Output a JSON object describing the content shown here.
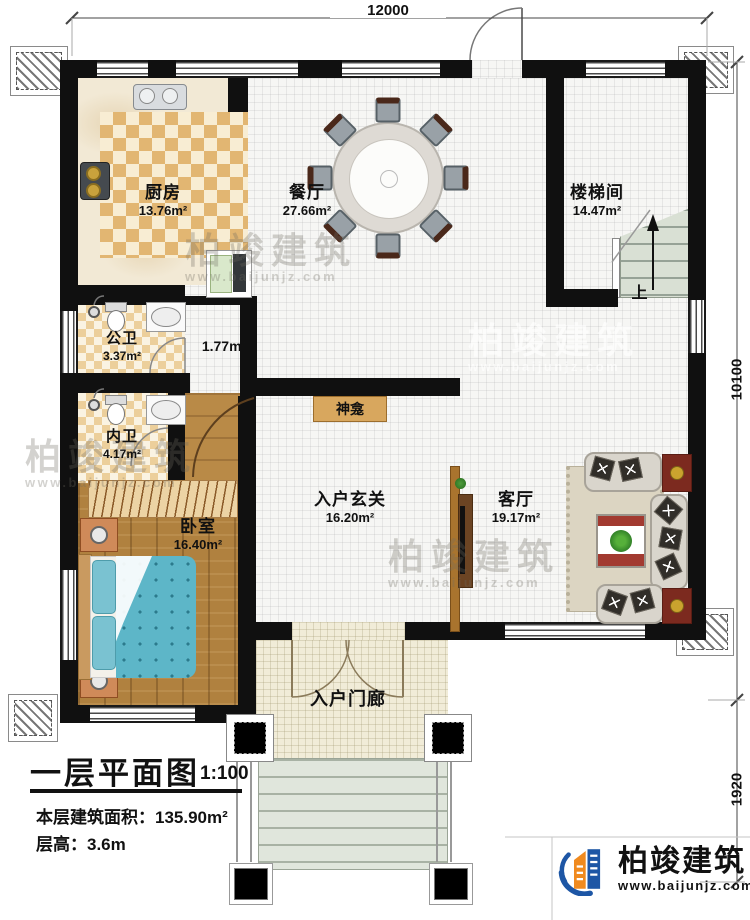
{
  "dimensions": {
    "top": "12000",
    "right_main": "10100",
    "right_porch": "1920"
  },
  "rooms": [
    {
      "name": "厨房",
      "area": "13.76m²"
    },
    {
      "name": "餐厅",
      "area": "27.66m²"
    },
    {
      "name": "楼梯间",
      "area": "14.47m²"
    },
    {
      "name": "公卫",
      "area": "3.37m²"
    },
    {
      "name": "",
      "area": "1.77m²"
    },
    {
      "name": "内卫",
      "area": "4.17m²"
    },
    {
      "name": "卧室",
      "area": "16.40m²"
    },
    {
      "name": "入户玄关",
      "area": "16.20m²"
    },
    {
      "name": "客厅",
      "area": "19.17m²"
    },
    {
      "name": "入户门廊",
      "area": ""
    }
  ],
  "labels": {
    "shrine": "神龛",
    "stairs_up": "上"
  },
  "title_block": {
    "title": "一层平面图",
    "scale": "1:100",
    "building_area": "本层建筑面积：135.90m²",
    "floor_height": "层高：3.6m"
  },
  "brand": {
    "name": "柏竣建筑",
    "website": "www.baijunjz.com"
  },
  "watermark": {
    "name": "柏竣建筑",
    "website": "www.baijunjz.com"
  }
}
